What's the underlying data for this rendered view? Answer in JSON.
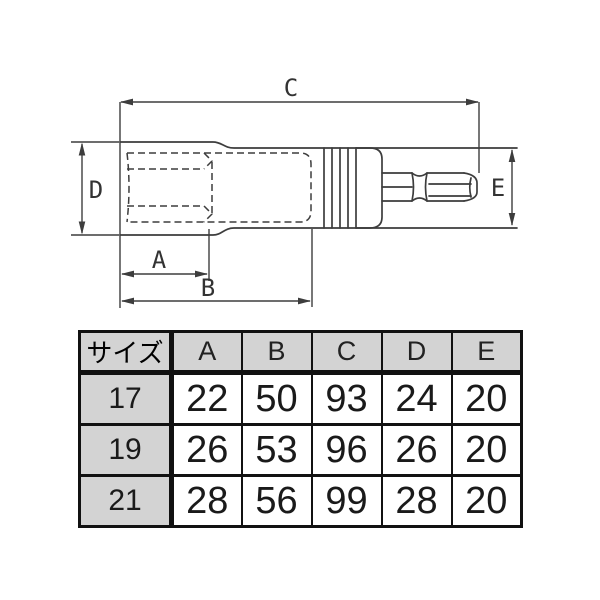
{
  "diagram": {
    "dim_labels": {
      "A": "A",
      "B": "B",
      "C": "C",
      "D": "D",
      "E": "E"
    }
  },
  "table": {
    "size_header": "サイズ",
    "dim_headers": [
      "A",
      "B",
      "C",
      "D",
      "E"
    ],
    "rows": [
      {
        "size": "17",
        "values": [
          "22",
          "50",
          "93",
          "24",
          "20"
        ]
      },
      {
        "size": "19",
        "values": [
          "26",
          "53",
          "96",
          "26",
          "20"
        ]
      },
      {
        "size": "21",
        "values": [
          "28",
          "56",
          "99",
          "28",
          "20"
        ]
      }
    ]
  },
  "colors": {
    "header_bg": "#d3d3d3",
    "table_border": "#111111",
    "drawing_line": "#3d3d3d",
    "background": "#ffffff"
  }
}
